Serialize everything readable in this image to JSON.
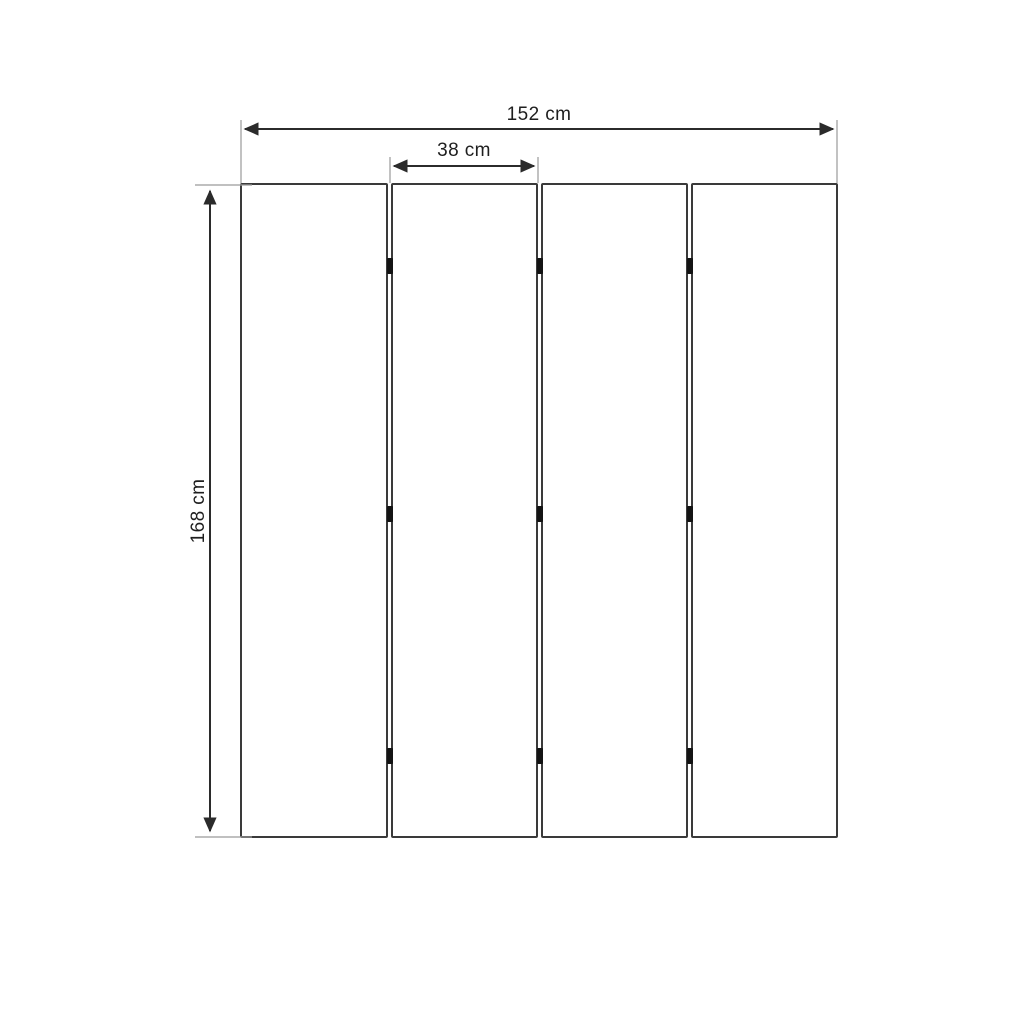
{
  "diagram": {
    "description": "Dimensional drawing of a four-panel folding screen / room divider",
    "panel_count": 4,
    "hinge_rows": 3,
    "hinge_count": 9
  },
  "dimensions": {
    "total_width": "152 cm",
    "panel_width": "38 cm",
    "height": "168 cm"
  },
  "colors": {
    "background": "#ffffff",
    "panel_border": "#3a3a3a",
    "dimension_line": "#2b2b2b",
    "extension_line": "#9a9a9a",
    "hinge": "#141414",
    "text": "#1f1f1f"
  }
}
